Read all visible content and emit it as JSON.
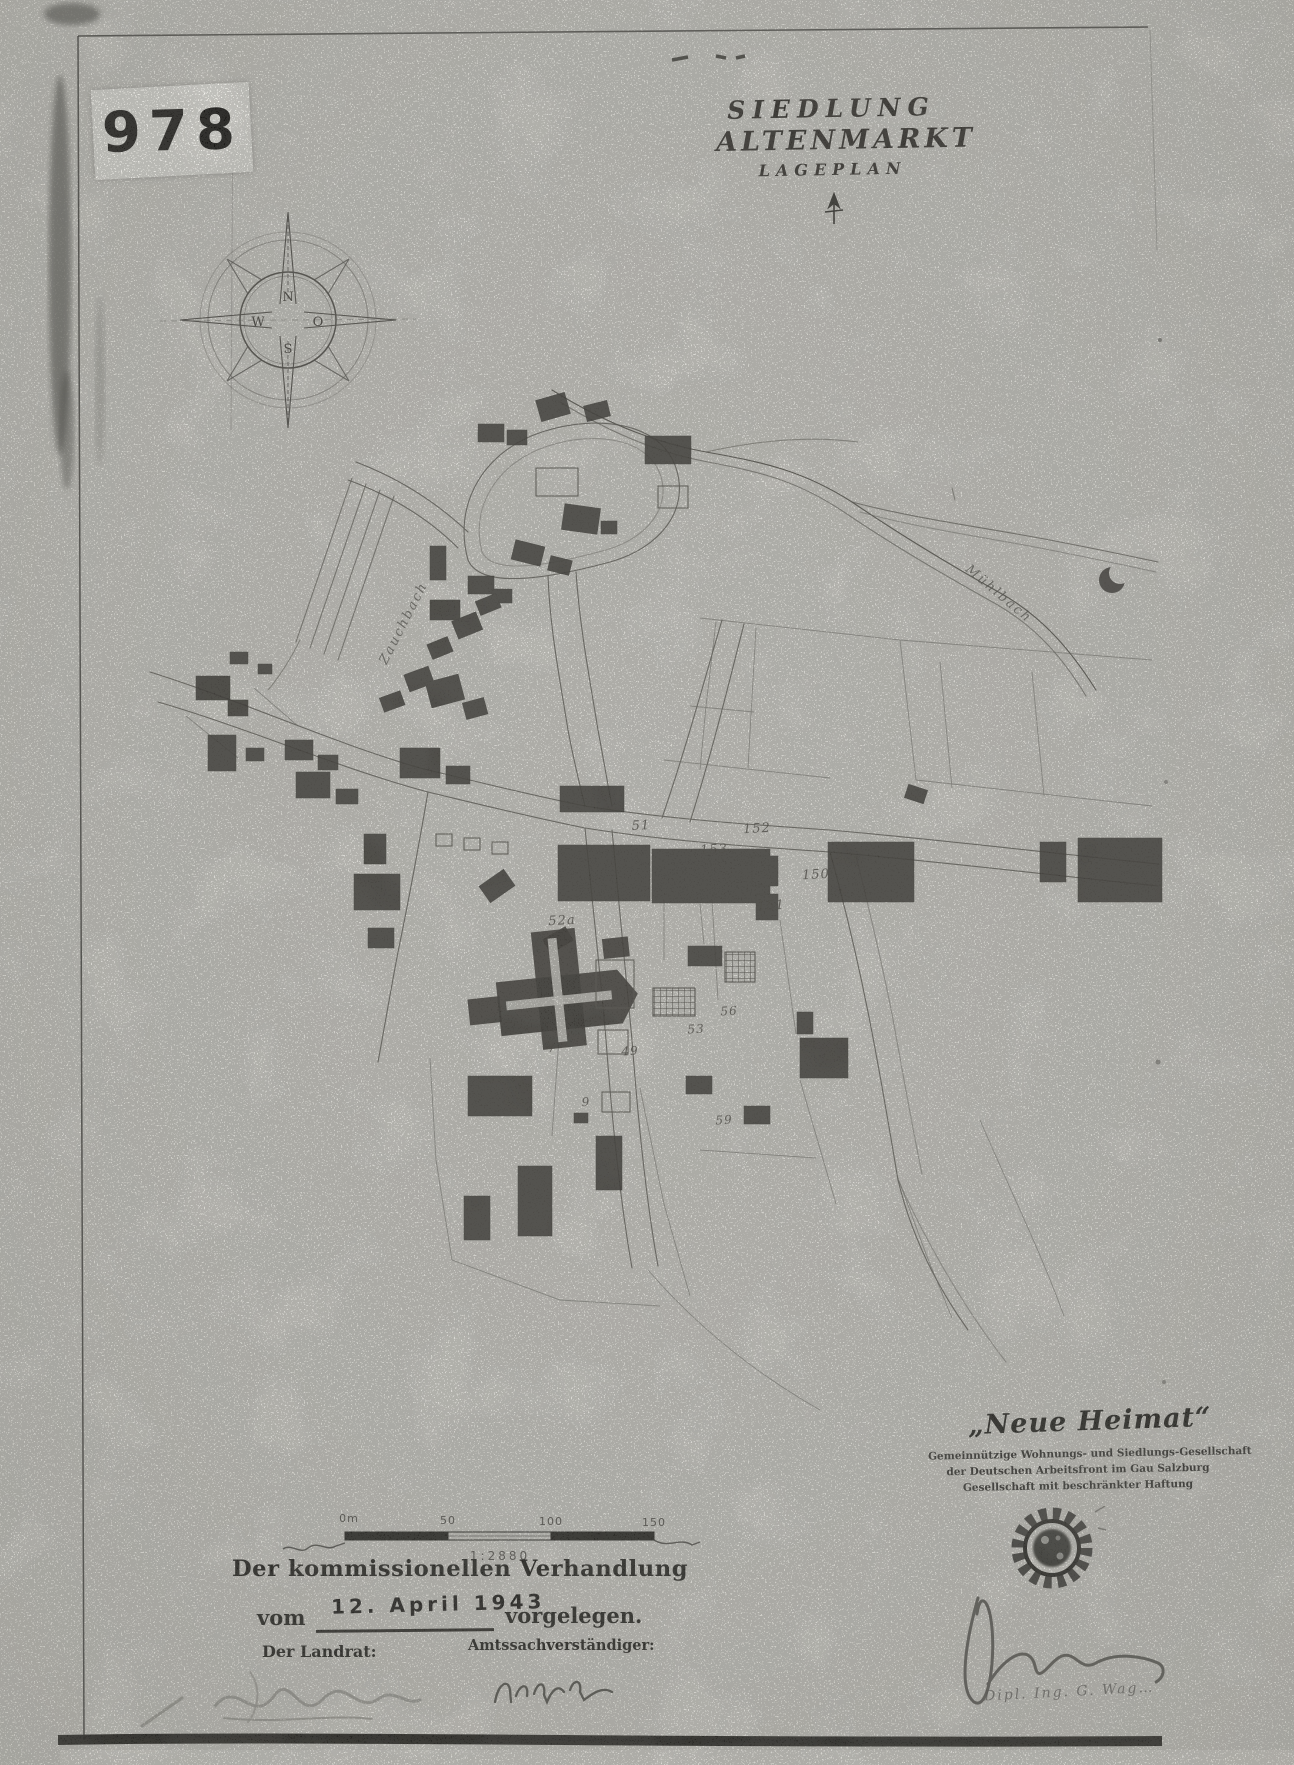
{
  "page": {
    "archive_label": "978",
    "paper_color": "#d9d8d3",
    "ink_color": "#2f2d29"
  },
  "title": {
    "line1": "SIEDLUNG",
    "line2": "ALTENMARKT",
    "line3": "LAGEPLAN"
  },
  "compass": {
    "n": "N",
    "o": "O",
    "s": "S",
    "w": "W"
  },
  "map": {
    "stream_label_left": "Zauchbach",
    "stream_label_right": "Mühlbach",
    "parcels": [
      {
        "label": "51"
      },
      {
        "label": "152"
      },
      {
        "label": "153"
      },
      {
        "label": "150"
      },
      {
        "label": "151"
      },
      {
        "label": "52a"
      },
      {
        "label": "56"
      },
      {
        "label": "53"
      },
      {
        "label": "55"
      },
      {
        "label": "9"
      },
      {
        "label": "49"
      },
      {
        "label": "7"
      },
      {
        "label": "59"
      }
    ]
  },
  "scale": {
    "tick0": "0m",
    "tick50": "50",
    "tick100": "100",
    "tick150": "150",
    "ratio": "1:2880"
  },
  "legal": {
    "line1": "Der kommissionellen Verhandlung",
    "vom": "vom",
    "date": "12. April 1943",
    "vorgelegen": "vorgelegen.",
    "landrat": "Der Landrat:",
    "amtssachverstaendiger": "Amtssachverständiger:"
  },
  "stamp": {
    "name": "„Neue Heimat“",
    "line2": "Gemeinnützige Wohnungs- und Siedlungs-Gesellschaft",
    "line3": "der Deutschen Arbeitsfront im Gau Salzburg",
    "line4": "Gesellschaft mit beschränkter Haftung"
  },
  "signatures": {
    "caption": "Dipl. Ing. G. Wag…"
  }
}
